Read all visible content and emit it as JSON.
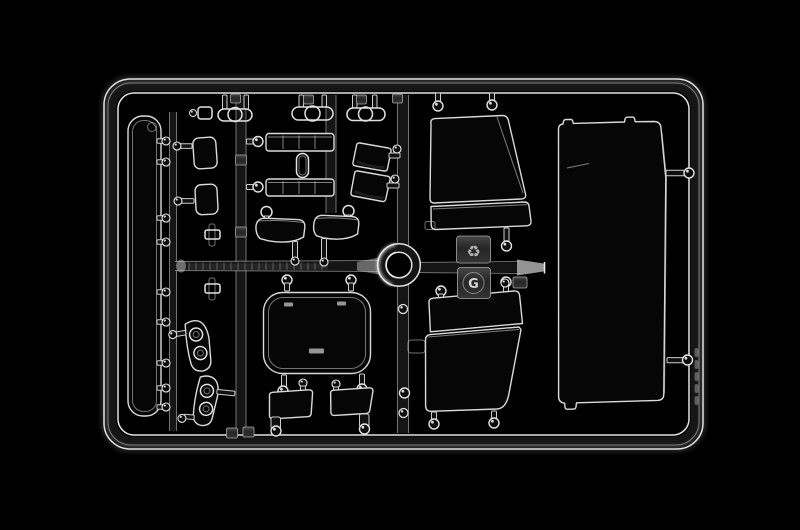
{
  "image": {
    "description": "Clear transparent plastic model-kit sprue (injection-molded parts tree with windshield, window and lamp-lens parts) photographed on a black background",
    "background_color": "#000000"
  },
  "sprue": {
    "letter_label": "G",
    "recycle_symbol": "♻",
    "colors": {
      "plastic_edge_highlight": "#e6e6e6",
      "plastic_specular": "#ffffff",
      "plastic_core_shadow": "#161616",
      "tinted_glass": "#060606",
      "frosted_tag": "#2f2f2f"
    },
    "parts": [
      "outer-frame",
      "runner-cross",
      "injection-ring",
      "long-glazing-strip",
      "windshield-glass",
      "door-window-upper",
      "door-window-lower",
      "roof-hatch-window",
      "quarter-window-a",
      "quarter-window-b",
      "mirror-glass-upper",
      "mirror-glass-lower",
      "curved-vent-glass-a",
      "curved-vent-glass-b",
      "slatted-lens-bar-upper",
      "slatted-lens-bar-lower",
      "marker-lamp-capsule-1",
      "marker-lamp-capsule-2",
      "marker-lamp-capsule-3",
      "headlamp-lens-upper",
      "headlamp-lens-lower",
      "small-pane-a",
      "small-pane-b",
      "recycling-tag",
      "sprue-letter-tag",
      "part-number-tags"
    ]
  }
}
